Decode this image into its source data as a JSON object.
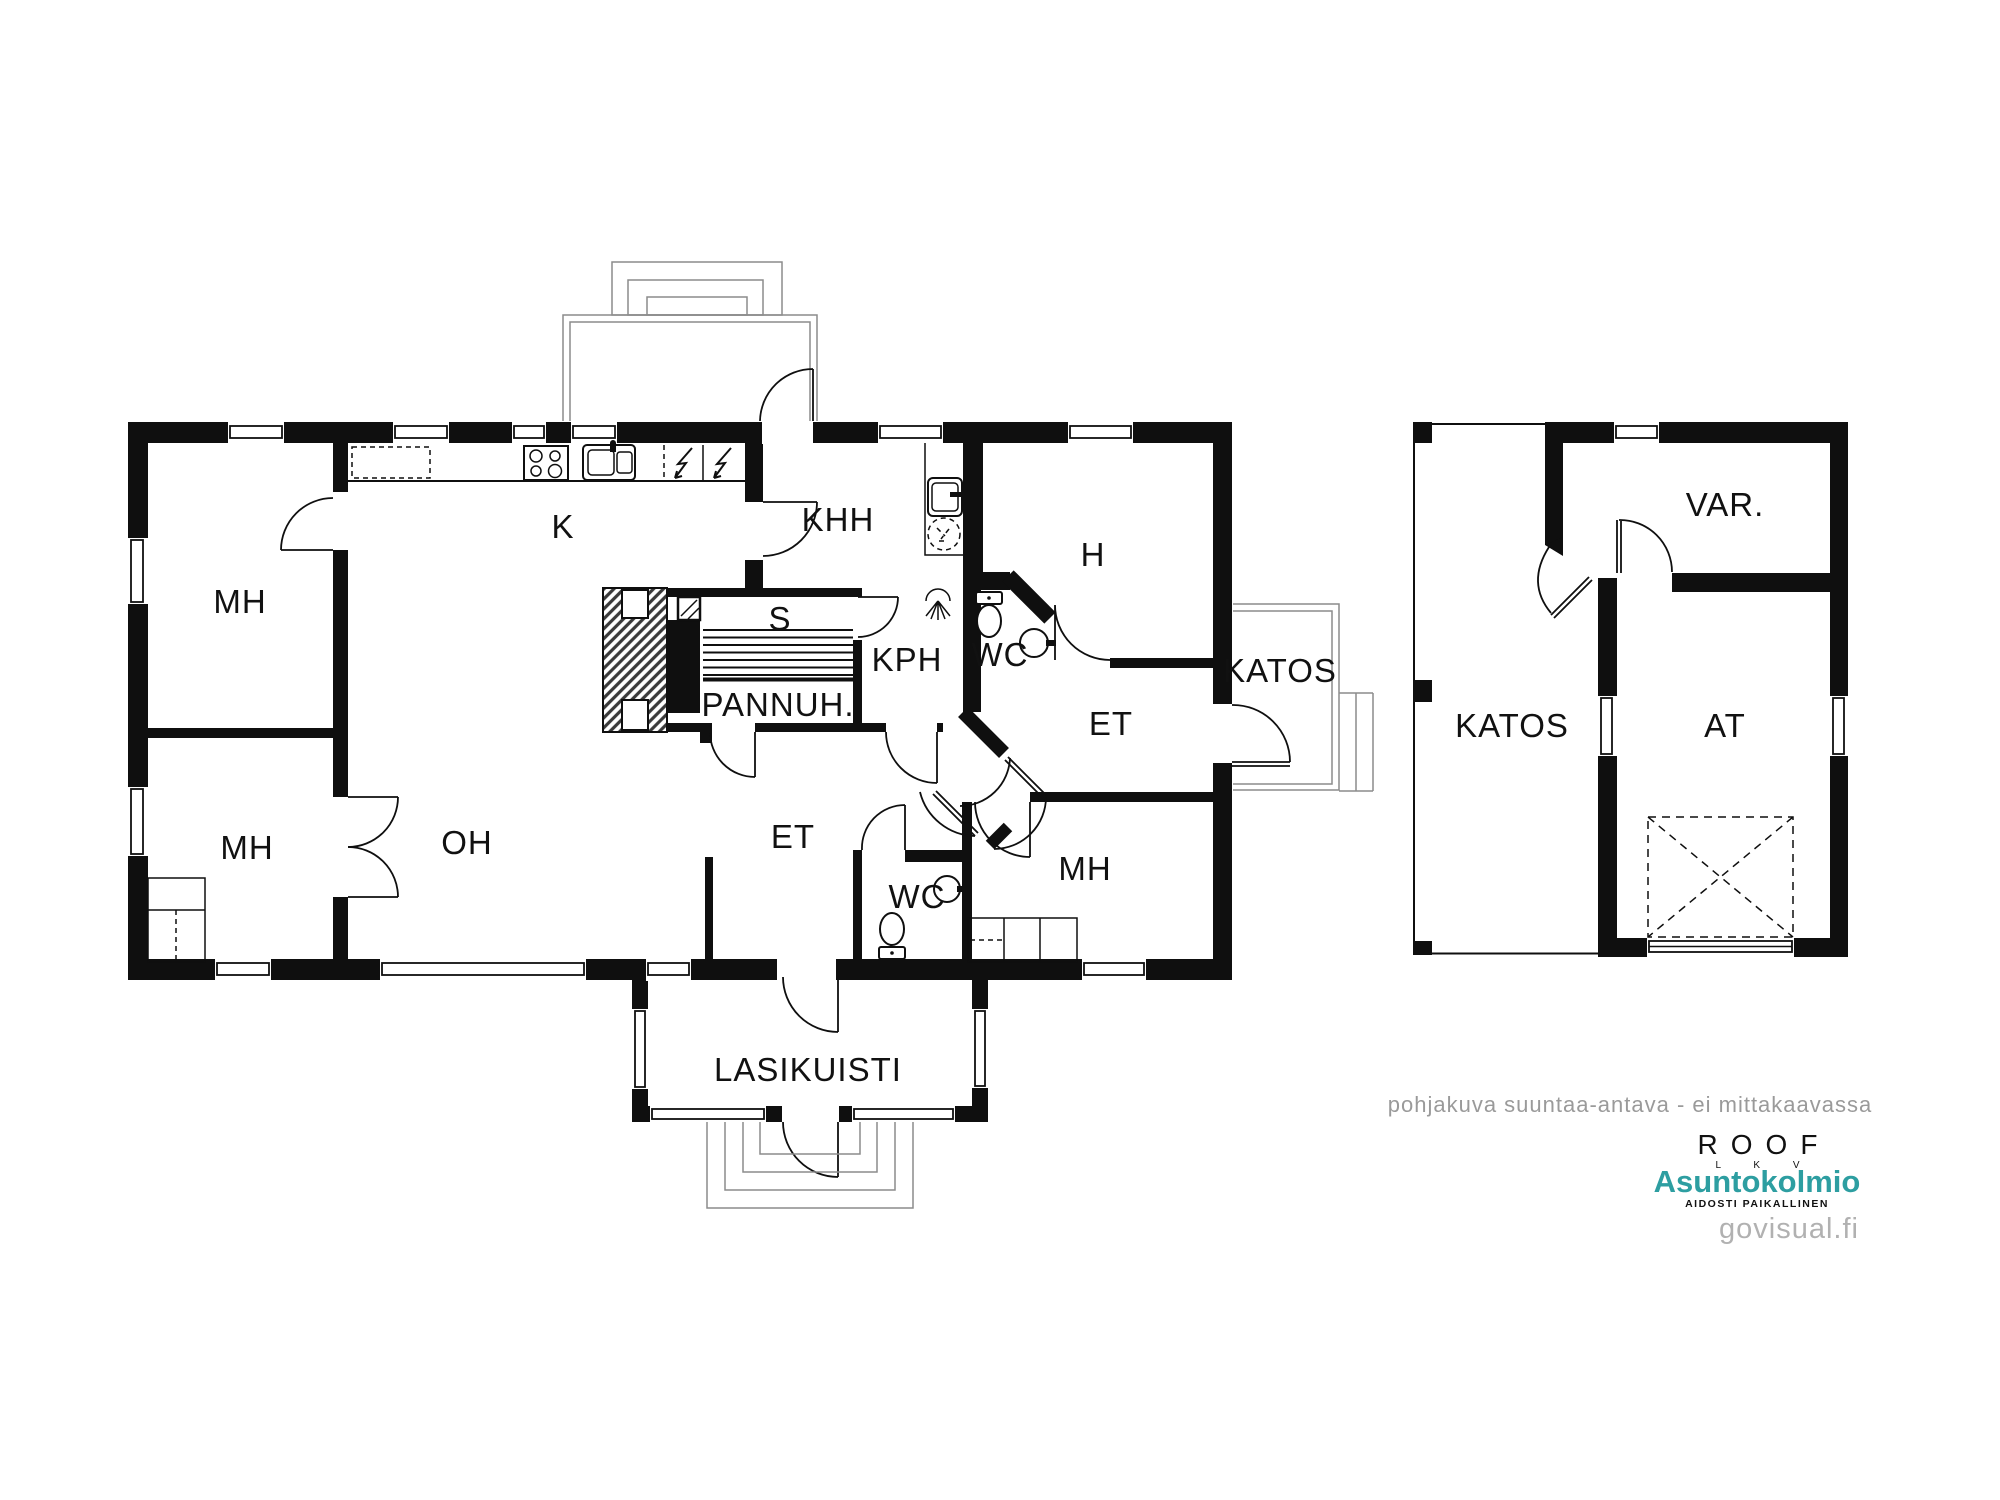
{
  "plan": {
    "disclaimer": "pohjakuva suuntaa-antava - ei mittakaavassa",
    "watermark": "govisual.fi",
    "roof_logo": {
      "name": "ROOF",
      "subtitle": "L K V"
    },
    "brand": {
      "name": "Asuntokolmio",
      "tagline": "AIDOSTI PAIKALLINEN",
      "color": "#2D9EA1"
    },
    "colors": {
      "wall": "#0F0F0F",
      "outline_gray": "#8C8C8C",
      "label": "#111111",
      "muted_text": "#9A9A9A",
      "watermark_gray": "#B1B1B1",
      "background": "#FFFFFF"
    },
    "rooms": [
      {
        "id": "mh-top-left",
        "label": "MH"
      },
      {
        "id": "mh-mid-left",
        "label": "MH"
      },
      {
        "id": "oh",
        "label": "OH"
      },
      {
        "id": "k",
        "label": "K"
      },
      {
        "id": "khh",
        "label": "KHH"
      },
      {
        "id": "s",
        "label": "S"
      },
      {
        "id": "pannuh",
        "label": "PANNUH."
      },
      {
        "id": "kph",
        "label": "KPH"
      },
      {
        "id": "wc-top",
        "label": "WC"
      },
      {
        "id": "h",
        "label": "H"
      },
      {
        "id": "et-center",
        "label": "ET"
      },
      {
        "id": "et-right",
        "label": "ET"
      },
      {
        "id": "wc-bottom",
        "label": "WC"
      },
      {
        "id": "mh-bottom-right",
        "label": "MH"
      },
      {
        "id": "katos-main",
        "label": "KATOS"
      },
      {
        "id": "lasikuisti",
        "label": "LASIKUISTI"
      },
      {
        "id": "katos-garage",
        "label": "KATOS"
      },
      {
        "id": "var",
        "label": "VAR."
      },
      {
        "id": "at",
        "label": "AT"
      }
    ],
    "icons": [
      "stove-icon",
      "kitchen-sink-icon",
      "electric-appliance-icon",
      "utility-sink-icon",
      "washing-machine-icon",
      "sauna-stove-icon",
      "sauna-benches-icon",
      "fireplace-icon",
      "shower-icon",
      "toilet-icon",
      "wc-sink-icon",
      "wardrobe-icon",
      "closet-icon",
      "garage-door-icon",
      "entrance-steps-icon",
      "terrace-outline-icon"
    ]
  }
}
